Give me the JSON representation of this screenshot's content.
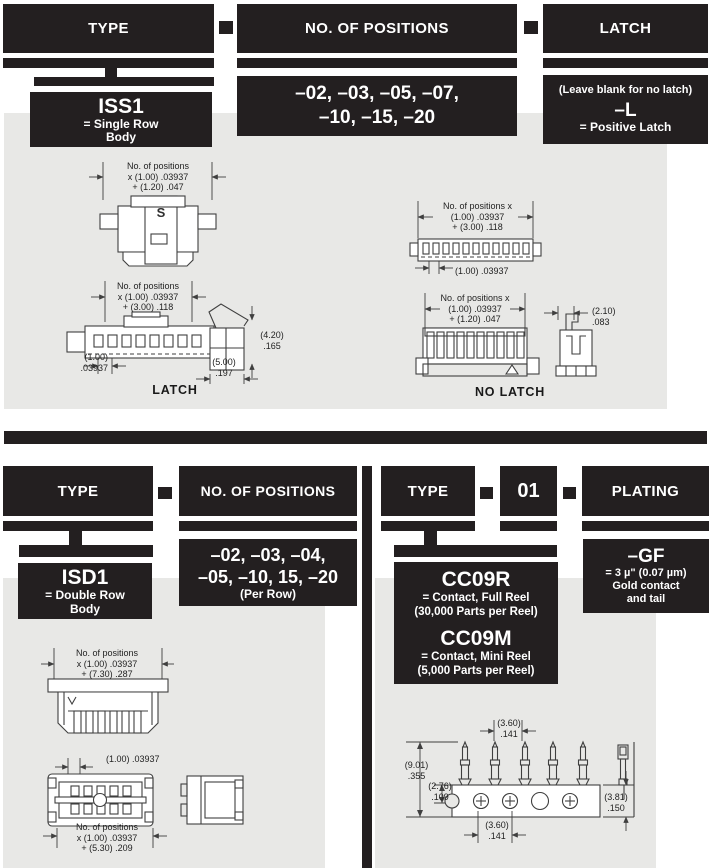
{
  "colors": {
    "black": "#231f20",
    "panel": "#e8e8e6",
    "line": "#3f3f3f",
    "white": "#ffffff"
  },
  "top_flow": {
    "headers": [
      "TYPE",
      "NO. OF POSITIONS",
      "LATCH"
    ],
    "type_value": {
      "code": "ISS1",
      "desc_line1": "= Single Row",
      "desc_line2": "Body"
    },
    "positions_value": {
      "line1": "–02, –03, –05, –07,",
      "line2": "–10, –15, –20"
    },
    "latch_value": {
      "note": "(Leave blank for no latch)",
      "code": "–L",
      "desc": "= Positive Latch"
    }
  },
  "top_drawings": {
    "mated_view": {
      "dim_line1": "No. of positions",
      "dim_line2": "x (1.00) .03937",
      "dim_line3": "+ (1.20) .047",
      "marking": "S"
    },
    "latch_view": {
      "dim_line1": "No. of positions",
      "dim_line2": "x (1.00) .03937",
      "dim_line3": "+ (3.00) .118",
      "pitch_line1": "(1.00)",
      "pitch_line2": ".03937",
      "height_line1": "(4.20)",
      "height_line2": ".165",
      "width_line1": "(5.00)",
      "width_line2": ".197",
      "caption": "LATCH"
    },
    "header_view": {
      "dim_line1": "No. of positions x",
      "dim_line2": "(1.00) .03937",
      "dim_line3": "+ (3.00) .118",
      "pitch": "(1.00) .03937"
    },
    "no_latch_view": {
      "dim_line1": "No. of positions x",
      "dim_line2": "(1.00) .03937",
      "dim_line3": "+ (1.20) .047",
      "width_line1": "(2.10)",
      "width_line2": ".083",
      "caption": "NO LATCH"
    }
  },
  "bottom_left_flow": {
    "headers": [
      "TYPE",
      "NO. OF POSITIONS"
    ],
    "type_value": {
      "code": "ISD1",
      "desc_line1": "= Double Row",
      "desc_line2": "Body"
    },
    "positions_value": {
      "line1": "–02, –03, –04,",
      "line2": "–05, –10, 15, –20",
      "line3": "(Per Row)"
    }
  },
  "bottom_right_flow": {
    "headers": [
      "TYPE",
      "01",
      "PLATING"
    ],
    "contact_value": {
      "code1": "CC09R",
      "desc1a": "= Contact, Full Reel",
      "desc1b": "(30,000 Parts per Reel)",
      "code2": "CC09M",
      "desc2a": "= Contact, Mini Reel",
      "desc2b": "(5,000 Parts per Reel)"
    },
    "plating_value": {
      "code": "–GF",
      "line1": "= 3 µ\" (0.07 µm)",
      "line2": "Gold contact",
      "line3": "and tail"
    }
  },
  "bottom_drawings": {
    "isd_top_view": {
      "dim_line1": "No. of positions",
      "dim_line2": "x (1.00) .03937",
      "dim_line3": "+ (7.30) .287"
    },
    "isd_front_view": {
      "pitch": "(1.00) .03937",
      "dim_line1": "No. of positions",
      "dim_line2": "x (1.00) .03937",
      "dim_line3": "+ (5.30) .209"
    },
    "contact_view": {
      "top_w1": "(3.60)",
      "top_w2": ".141",
      "h1": "(9.01)",
      "h2": ".355",
      "h3": "(2.76)",
      "h4": ".109",
      "r1": "(3.81)",
      "r2": ".150",
      "b1": "(3.60)",
      "b2": ".141"
    }
  }
}
